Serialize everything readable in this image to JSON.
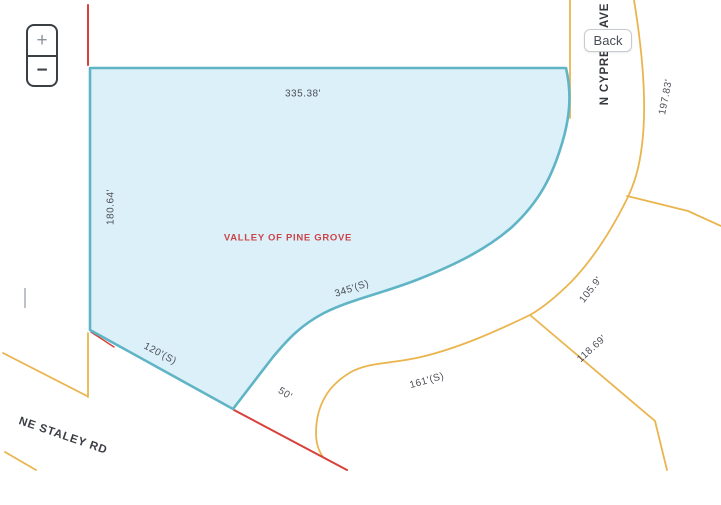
{
  "controls": {
    "zoom_in": "+",
    "zoom_out": "−",
    "back": "Back"
  },
  "parcel": {
    "name": "VALLEY OF PINE GROVE"
  },
  "streets": {
    "staley": "NE STALEY RD",
    "cypress": "N CYPRESS AVE"
  },
  "dimensions": {
    "top": "335.38'",
    "west": "180.64'",
    "southeast": "345'(S)",
    "southwest": "120'(S)",
    "south_small": "50'",
    "south_curve": "161'(S)",
    "east_upper": "105.9'",
    "east_lower": "118.69'",
    "cypress_east": "197.83'"
  },
  "colors": {
    "parcel_fill": "#d9eff8",
    "parcel_stroke": "#5fb4c6",
    "road": "#eab54e",
    "boundary_red": "#d8403a",
    "parcel_label": "#cc4449",
    "dimension_text": "#4d4f57"
  }
}
